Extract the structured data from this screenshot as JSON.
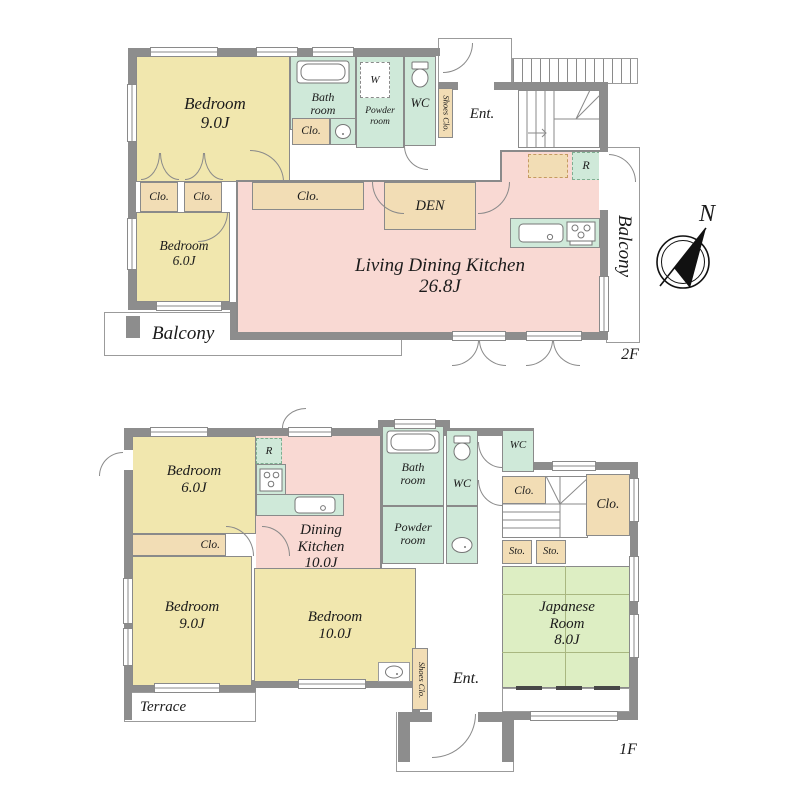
{
  "figure": {
    "type": "two-storey house floor plan",
    "compass_north": "N"
  },
  "palette": {
    "room_yellow": "#f1e7ae",
    "room_pink": "#f9d9d3",
    "room_green": "#cfe9d9",
    "room_tan": "#f2ddb5",
    "tatami_green": "#ddeec3",
    "wall_gray": "#8d8d8d"
  },
  "floor2": {
    "label": "2F",
    "rooms": {
      "bedroom9": "Bedroom\n9.0J",
      "bedroom6": "Bedroom\n6.0J",
      "ldk": "Living Dining Kitchen\n26.8J",
      "den": "DEN",
      "bathroom": "Bath\nroom",
      "powder_room": "Powder\nroom",
      "wc": "WC",
      "washer": "W",
      "fridge": "R",
      "closet": "Clo.",
      "shoes_closet": "Shoes Clo.",
      "entrance": "Ent.",
      "balcony_side": "Balcony",
      "balcony_rear": "Balcony"
    }
  },
  "floor1": {
    "label": "1F",
    "rooms": {
      "bedroom6": "Bedroom\n6.0J",
      "bedroom9": "Bedroom\n9.0J",
      "bedroom10": "Bedroom\n10.0J",
      "dining_kitchen": "Dining\nKitchen\n10.0J",
      "japanese_room": "Japanese\nRoom\n8.0J",
      "bathroom": "Bath\nroom",
      "powder_room": "Powder\nroom",
      "wc": "WC",
      "fridge": "R",
      "closet": "Clo.",
      "storage": "Sto.",
      "shoes_closet": "Shoes Clo.",
      "entrance": "Ent.",
      "terrace": "Terrace"
    }
  }
}
